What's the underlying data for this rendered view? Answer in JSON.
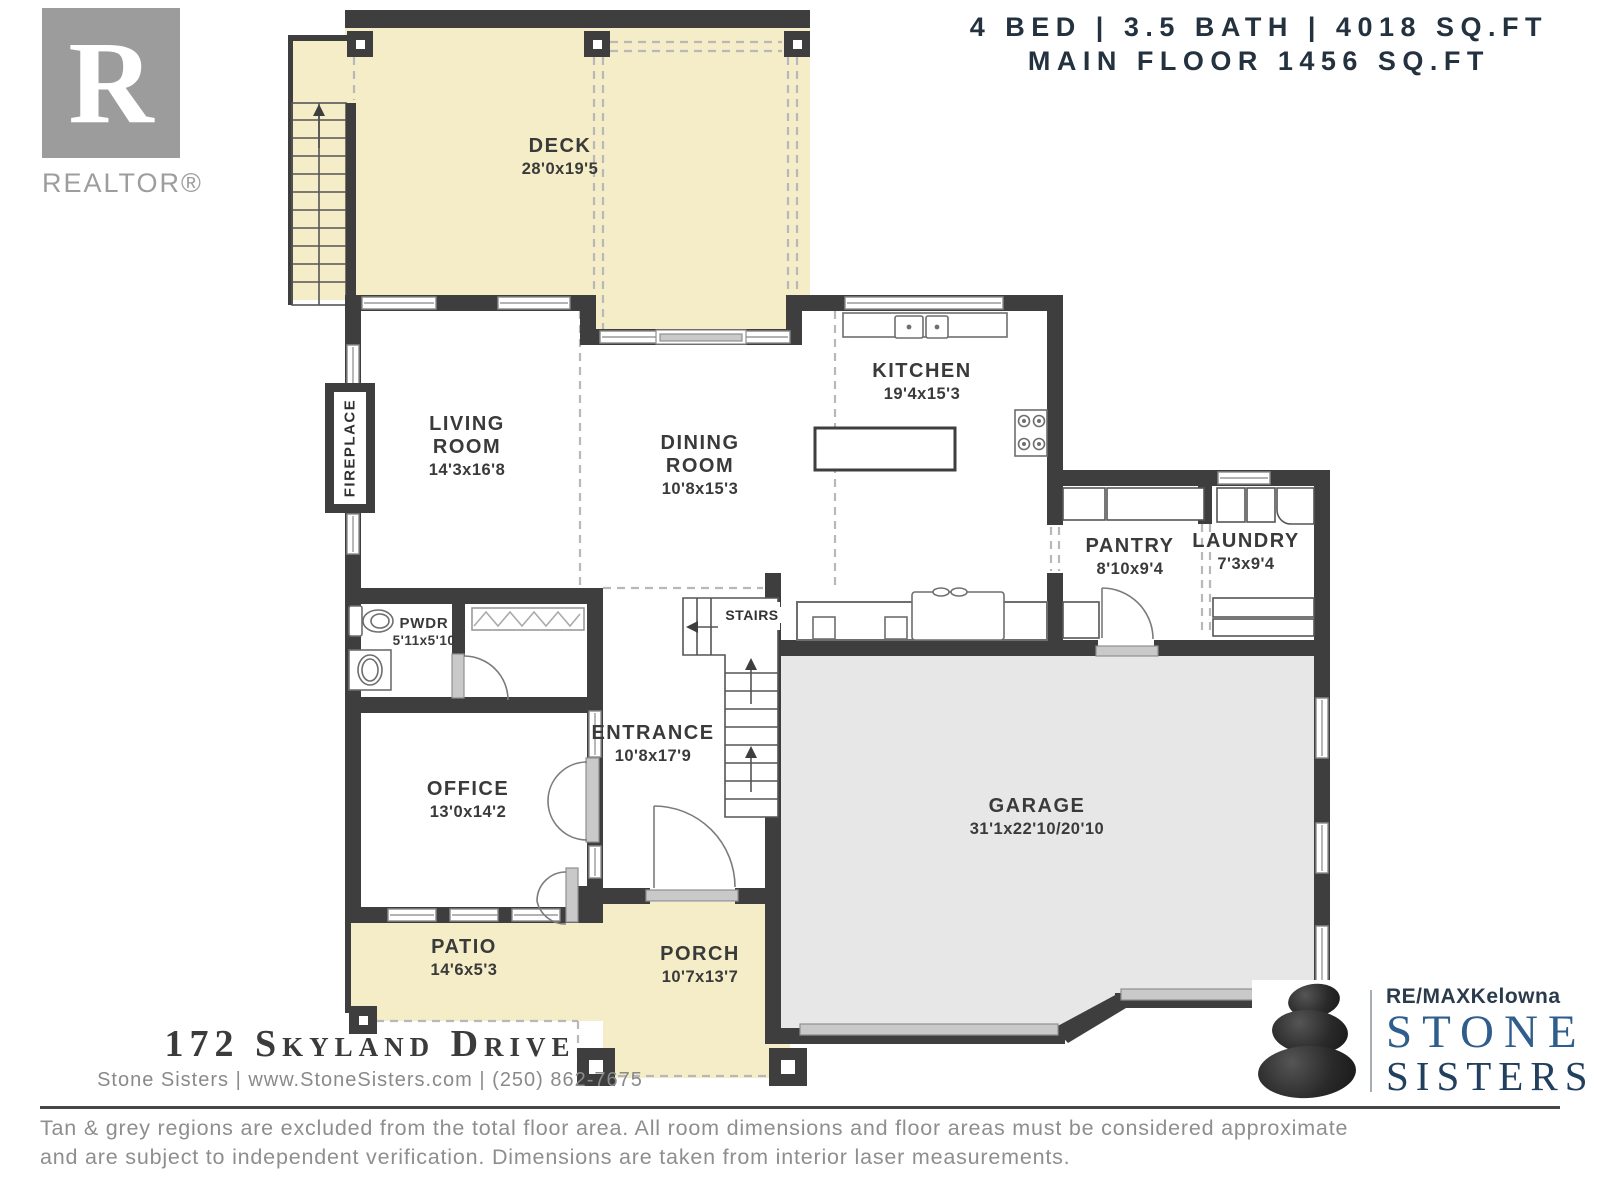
{
  "header": {
    "specs_line1": "4 BED | 3.5 BATH | 4018 SQ.FT",
    "specs_line2": "MAIN FLOOR 1456 SQ.FT",
    "realtor": {
      "letter": "R",
      "label": "REALTOR®"
    }
  },
  "rooms": [
    {
      "id": "deck",
      "name": "DECK",
      "dims": "28'0x19'5"
    },
    {
      "id": "living-room",
      "name": "LIVING ROOM",
      "dims": "14'3x16'8"
    },
    {
      "id": "dining-room",
      "name": "DINING ROOM",
      "dims": "10'8x15'3"
    },
    {
      "id": "kitchen",
      "name": "KITCHEN",
      "dims": "19'4x15'3"
    },
    {
      "id": "pantry",
      "name": "PANTRY",
      "dims": "8'10x9'4"
    },
    {
      "id": "laundry",
      "name": "LAUNDRY",
      "dims": "7'3x9'4"
    },
    {
      "id": "powder-room",
      "name": "PWDR",
      "dims": "5'11x5'10"
    },
    {
      "id": "office",
      "name": "OFFICE",
      "dims": "13'0x14'2"
    },
    {
      "id": "entrance",
      "name": "ENTRANCE",
      "dims": "10'8x17'9"
    },
    {
      "id": "garage",
      "name": "GARAGE",
      "dims": "31'1x22'10/20'10"
    },
    {
      "id": "patio",
      "name": "PATIO",
      "dims": "14'6x5'3"
    },
    {
      "id": "porch",
      "name": "PORCH",
      "dims": "10'7x13'7"
    }
  ],
  "plan_labels": {
    "stairs": "STAIRS",
    "fireplace": "FIREPLACE"
  },
  "footer": {
    "address": "172 Skyland Drive",
    "contact": "Stone Sisters | www.StoneSisters.com | (250) 862-7675",
    "disclaimer_line1": "Tan & grey regions are excluded from the total floor area. All room dimensions and floor areas must be considered approximate",
    "disclaimer_line2": "and are subject to independent verification. Dimensions are taken from interior laser measurements."
  },
  "branding": {
    "remax": "RE/MAXKelowna",
    "stone": "STONE",
    "sisters": "SISTERS"
  },
  "colors": {
    "tan": "#F4EDC7",
    "garage_grey": "#E7E7E7",
    "wall": "#3E3E3E",
    "dashed_grey": "#B8B8B8",
    "door_grey": "#C9C9C9",
    "label_text": "#3A3A3A",
    "header_text": "#243240",
    "stone_blue": "#2F5E8C",
    "sisters_navy": "#21405E",
    "footer_grey": "#8E8E8E"
  }
}
